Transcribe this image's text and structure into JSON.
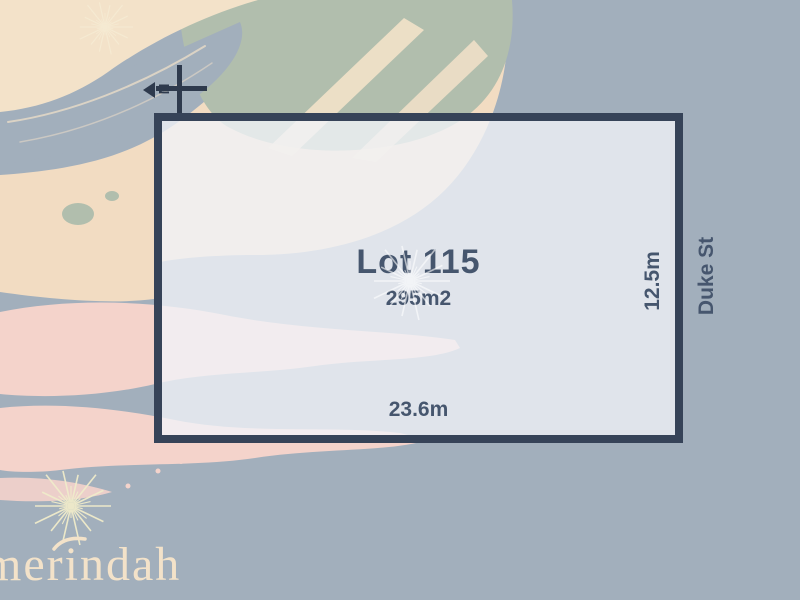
{
  "lot": {
    "label": "Lot 115",
    "area": "295m2",
    "frontage": "23.6m",
    "depth": "12.5m",
    "street": "Duke St"
  },
  "compass": {
    "label": "N"
  },
  "watermark": {
    "text": "merindah"
  },
  "icons": {
    "north": "north-arrow-icon",
    "sparkle": "sparkle-icon",
    "leaf": "leaf-flourish-icon"
  },
  "palette": {
    "base": "#a2afbc",
    "peach": "#f2dcc2",
    "sage": "#b1bead",
    "pink": "#f4d3cb",
    "cream": "#f3e2c9",
    "paleYellow": "#f0ecca",
    "ink": "#46566e",
    "inkDark": "#2e3a4d",
    "lotBorder": "#364358",
    "lotFill": "rgba(241,243,248,0.78)"
  }
}
